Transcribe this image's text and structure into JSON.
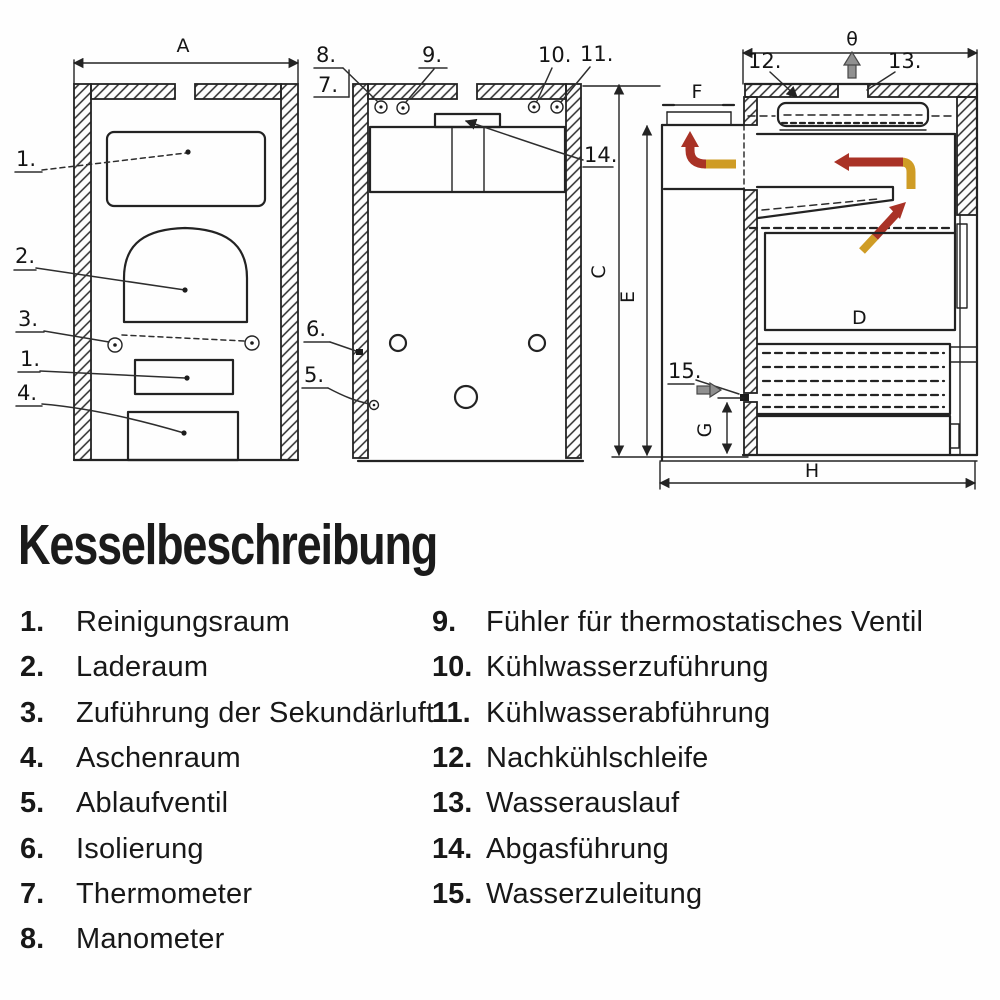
{
  "palette": {
    "paper": "#fefefe",
    "ink": "#232323",
    "flame_red": "#a93226",
    "flame_gold": "#cf9c25",
    "steel_gray": "#909090"
  },
  "legend": {
    "title": "Kesselbeschreibung",
    "columns": [
      {
        "items": [
          {
            "num": "1.",
            "label": "Reinigungsraum"
          },
          {
            "num": "2.",
            "label": "Laderaum"
          },
          {
            "num": "3.",
            "label": "Zuführung der Sekundärluft"
          },
          {
            "num": "4.",
            "label": "Aschenraum"
          },
          {
            "num": "5.",
            "label": "Ablaufventil"
          },
          {
            "num": "6.",
            "label": "Isolierung"
          },
          {
            "num": "7.",
            "label": "Thermometer"
          },
          {
            "num": "8.",
            "label": "Manometer"
          }
        ]
      },
      {
        "items": [
          {
            "num": "9.",
            "label": "Fühler für thermostatisches Ventil"
          },
          {
            "num": "10.",
            "label": "Kühlwasserzuführung"
          },
          {
            "num": "11.",
            "label": "Kühlwasserabführung"
          },
          {
            "num": "12.",
            "label": "Nachkühlschleife"
          },
          {
            "num": "13.",
            "label": "Wasserauslauf"
          },
          {
            "num": "14.",
            "label": "Abgasführung"
          },
          {
            "num": "15.",
            "label": "Wasserzuleitung"
          }
        ]
      }
    ]
  },
  "diagram": {
    "front_view": {
      "dim_a": "A",
      "c1_top": "1.",
      "c2": "2.",
      "c3": "3.",
      "c1_mid": "1.",
      "c4": "4."
    },
    "rear_view": {
      "c8": "8.",
      "c7": "7.",
      "c9": "9.",
      "c10": "10.",
      "c11": "11.",
      "c14": "14.",
      "c6": "6.",
      "c5": "5."
    },
    "side_view": {
      "dim_b": "θ",
      "c12": "12.",
      "c13": "13.",
      "c15": "15.",
      "dim_f": "F",
      "dim_c": "C",
      "dim_e": "E",
      "dim_d": "D",
      "dim_g": "G",
      "dim_h": "H"
    }
  }
}
